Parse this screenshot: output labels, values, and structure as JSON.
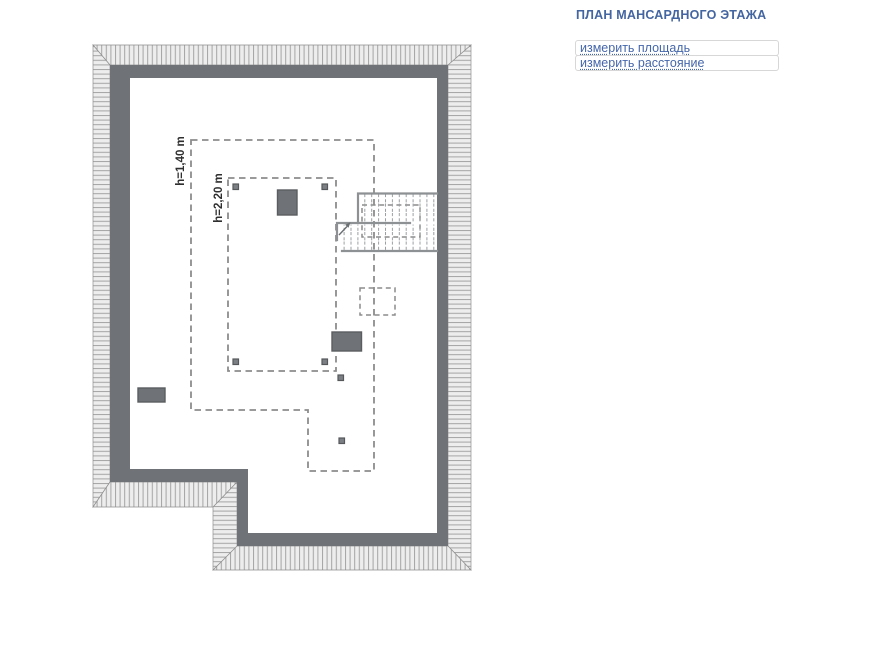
{
  "header": {
    "title": "ПЛАН МАНСАРДНОГО ЭТАЖА"
  },
  "tools": {
    "measure_area_label": "измерить площадь",
    "measure_distance_label": "измерить расстояние"
  },
  "plan": {
    "height_zone_low_label": "h=1,40 m",
    "height_zone_high_label": "h=2,20 m",
    "colors": {
      "wall": "#6f7377",
      "hatch_background": "#ededed",
      "hatch_line": "#a4a4a4",
      "hatch_border": "#8f8f8f",
      "dashed_zone_line": "#8c8c8c",
      "stair_line": "#8d9194",
      "tread_line": "#9b9fa2",
      "post_fill": "#7c8084",
      "post_border": "#55585b",
      "chimney_border": "#5a5d60",
      "label_text": "#2f2f2f",
      "title_blue": "#4365a0",
      "link_blue": "#4466aa"
    }
  }
}
